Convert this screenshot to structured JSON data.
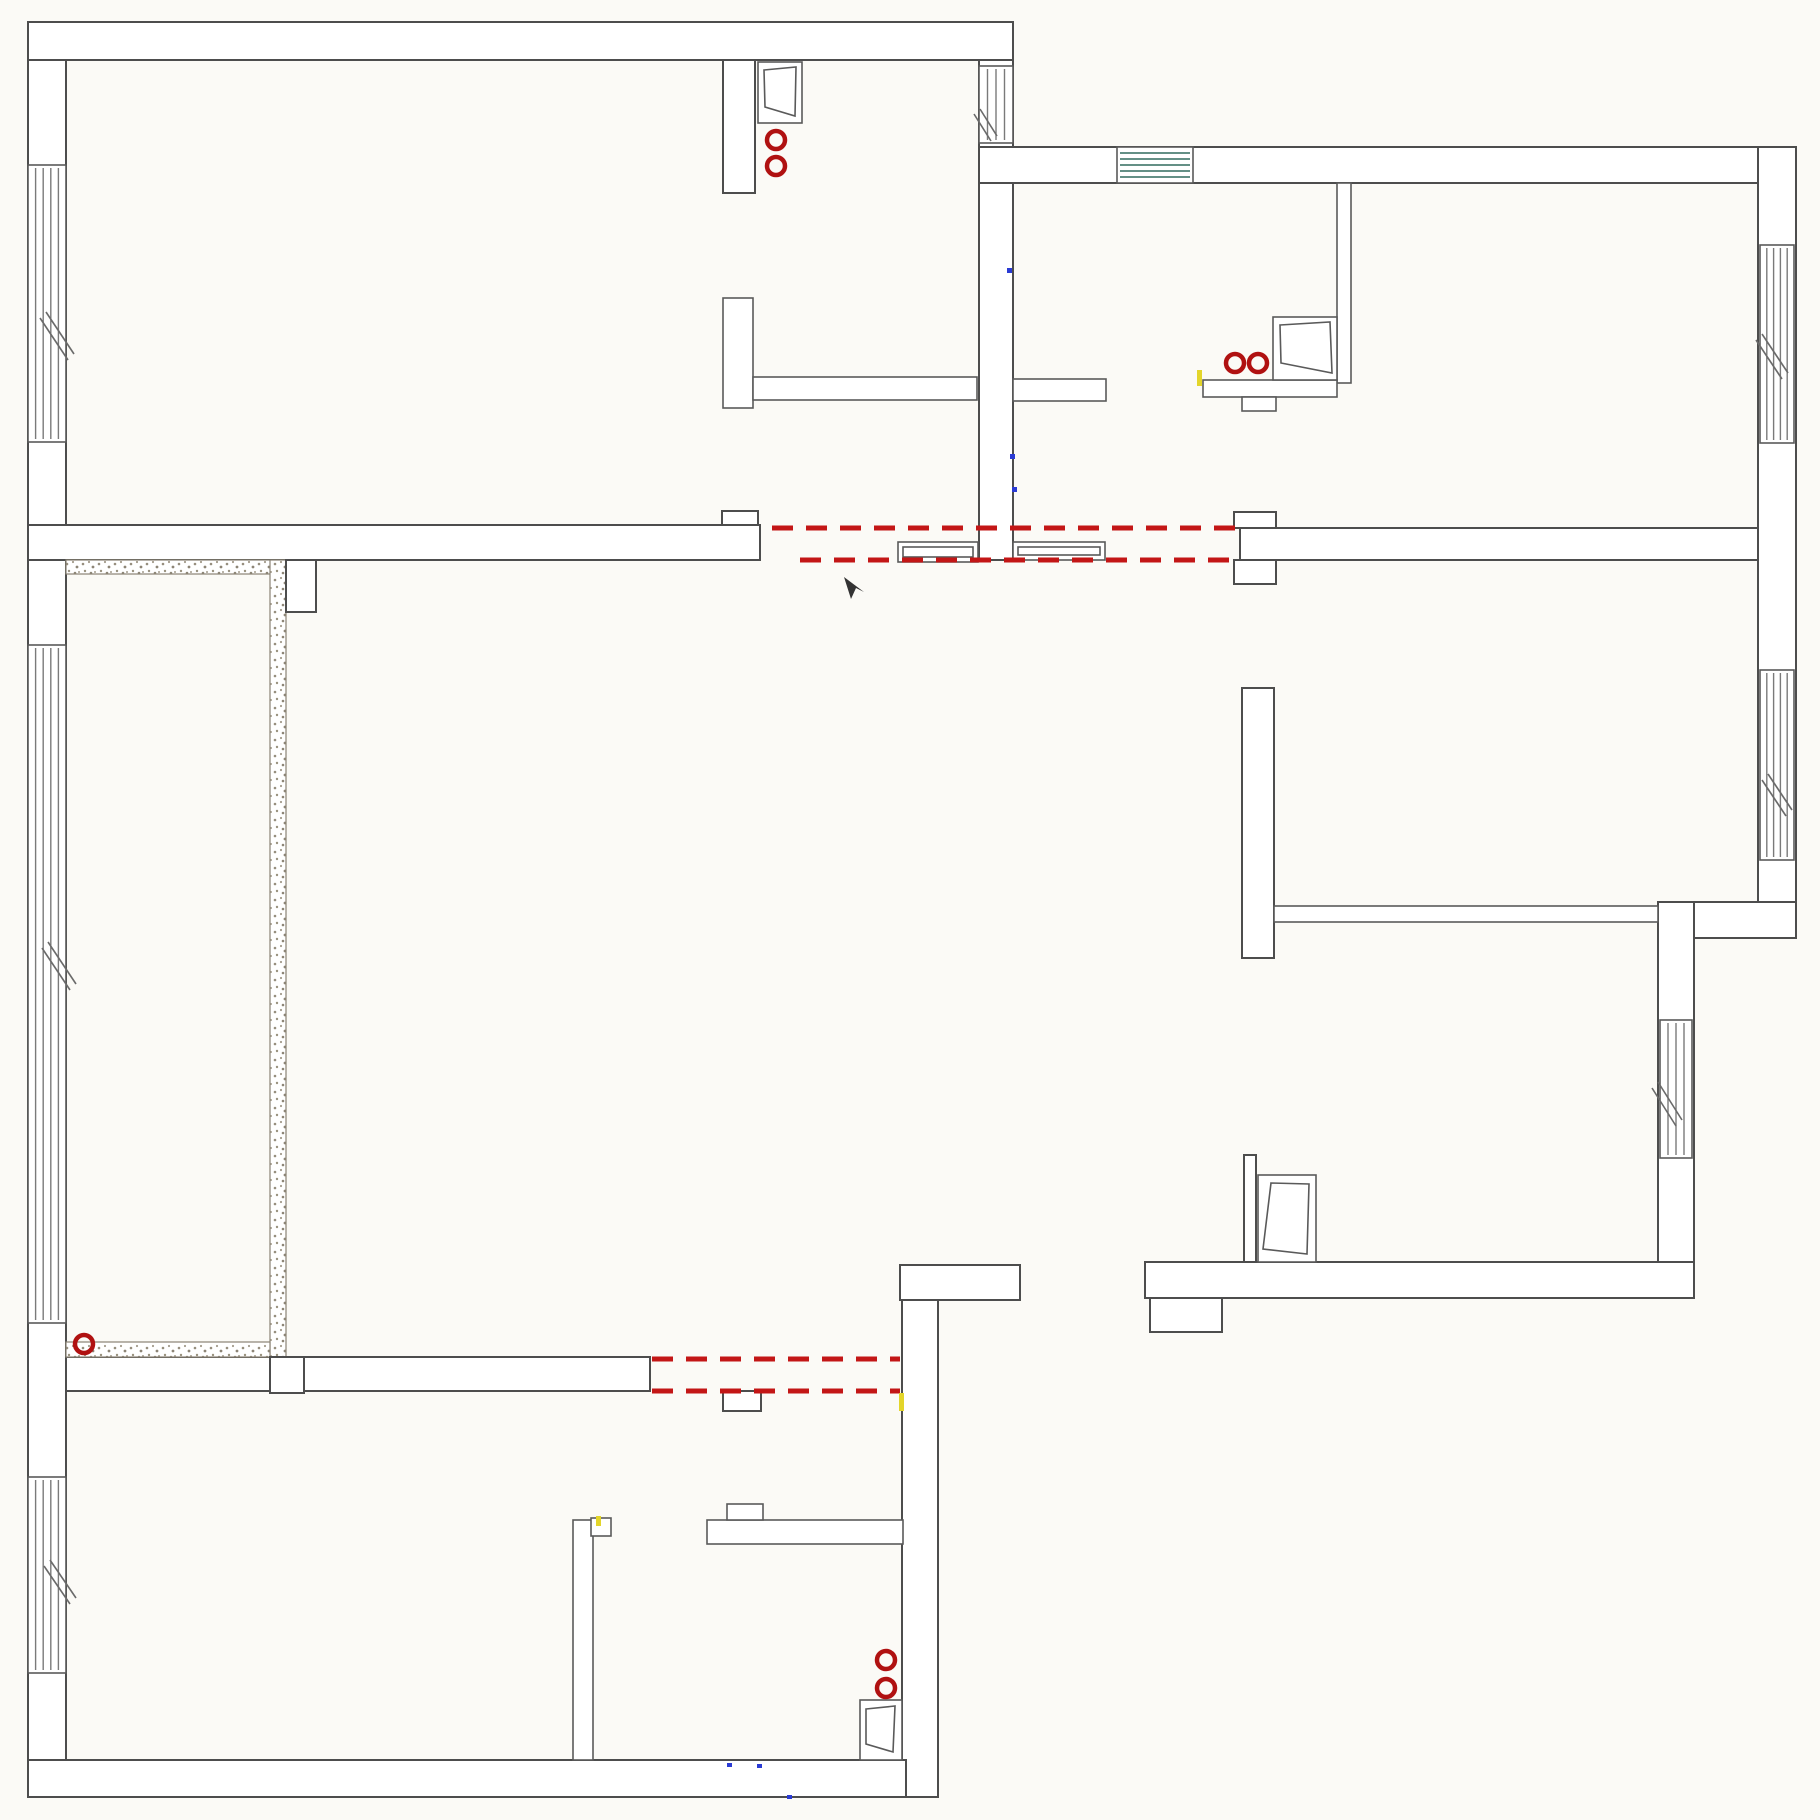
{
  "canvas": {
    "width": 1820,
    "height": 1820,
    "background": "#fbfaf6"
  },
  "palette": {
    "wall_line": "#4d4d4d",
    "thin_line": "#5a5a5a",
    "glass_line": "#7a7a7a",
    "glass_tint": "#316b5f",
    "demolition_red": "#c31616",
    "outlet_red": "#b01111",
    "speckle": "#8a8374",
    "mark_yellow": "#e3d52a",
    "mark_blue": "#2a3bd4",
    "arrow_dark": "#333333"
  },
  "plan": {
    "elements": [
      {
        "type": "rect",
        "name": "left-exterior-wall",
        "x": 28,
        "y": 22,
        "w": 38,
        "h": 1775
      },
      {
        "type": "rect",
        "name": "top-exterior-wall-west",
        "x": 28,
        "y": 22,
        "w": 985,
        "h": 38
      },
      {
        "type": "rect",
        "name": "entry-corridor-wall",
        "x": 979,
        "y": 60,
        "w": 34,
        "h": 500
      },
      {
        "type": "rect",
        "name": "top-exterior-wall-east",
        "x": 979,
        "y": 147,
        "w": 817,
        "h": 36
      },
      {
        "type": "rect",
        "name": "right-exterior-wall-upper",
        "x": 1758,
        "y": 147,
        "w": 38,
        "h": 791
      },
      {
        "type": "rect",
        "name": "right-exterior-step-wall",
        "x": 1658,
        "y": 902,
        "w": 138,
        "h": 36
      },
      {
        "type": "rect",
        "name": "right-exterior-wall-lower",
        "x": 1658,
        "y": 902,
        "w": 36,
        "h": 396
      },
      {
        "type": "rect",
        "name": "bottom-right-room-south-wall",
        "x": 1145,
        "y": 1262,
        "w": 549,
        "h": 36
      },
      {
        "type": "rect",
        "name": "bottom-right-room-pilaster",
        "x": 1150,
        "y": 1298,
        "w": 72,
        "h": 34
      },
      {
        "type": "rect",
        "name": "center-wall-bar",
        "x": 900,
        "y": 1265,
        "w": 120,
        "h": 35
      },
      {
        "type": "rect",
        "name": "center-wall-vertical",
        "x": 902,
        "y": 1300,
        "w": 36,
        "h": 497
      },
      {
        "type": "rect",
        "name": "bottom-exterior-wall",
        "x": 28,
        "y": 1760,
        "w": 878,
        "h": 37
      },
      {
        "type": "rect",
        "name": "top-left-room-south-wall",
        "x": 28,
        "y": 525,
        "w": 732,
        "h": 35
      },
      {
        "type": "rect",
        "name": "top-left-door-jamb",
        "x": 722,
        "y": 511,
        "w": 36,
        "h": 14
      },
      {
        "type": "rect",
        "name": "niche-divider-wall",
        "x": 723,
        "y": 60,
        "w": 32,
        "h": 133
      },
      {
        "type": "rect",
        "name": "bedroom-south-wall",
        "x": 1240,
        "y": 528,
        "w": 518,
        "h": 32
      },
      {
        "type": "rect",
        "name": "bedroom-door-jamb-upper",
        "x": 1234,
        "y": 512,
        "w": 42,
        "h": 16
      },
      {
        "type": "rect",
        "name": "bedroom-door-jamb-lower",
        "x": 1234,
        "y": 560,
        "w": 42,
        "h": 24
      },
      {
        "type": "rect",
        "name": "study-west-wall",
        "x": 1242,
        "y": 688,
        "w": 32,
        "h": 270
      },
      {
        "type": "rect",
        "name": "hall-south-wall",
        "x": 66,
        "y": 1357,
        "w": 584,
        "h": 34
      },
      {
        "type": "rect",
        "name": "hall-door-jamb",
        "x": 723,
        "y": 1391,
        "w": 38,
        "h": 20
      },
      {
        "type": "rect",
        "name": "bath-partition-wall",
        "x": 1244,
        "y": 1155,
        "w": 12,
        "h": 107
      },
      {
        "type": "rect",
        "cls": "thin",
        "name": "closet-wall-vertical",
        "x": 723,
        "y": 298,
        "w": 30,
        "h": 110
      },
      {
        "type": "rect",
        "cls": "thin",
        "name": "closet-rail-west",
        "x": 753,
        "y": 377,
        "w": 224,
        "h": 23
      },
      {
        "type": "rect",
        "cls": "thin",
        "name": "closet-rail-east",
        "x": 1013,
        "y": 379,
        "w": 93,
        "h": 22
      },
      {
        "type": "rect",
        "cls": "thin",
        "name": "study-south-wall",
        "x": 1274,
        "y": 906,
        "w": 384,
        "h": 16
      },
      {
        "type": "rect",
        "cls": "thin",
        "name": "kitchen-partition-wall",
        "x": 1337,
        "y": 183,
        "w": 14,
        "h": 200
      },
      {
        "type": "rect",
        "cls": "thin",
        "name": "kitchen-counter",
        "x": 1203,
        "y": 380,
        "w": 134,
        "h": 17
      },
      {
        "type": "rect",
        "cls": "thin",
        "name": "kitchen-counter-notch",
        "x": 1242,
        "y": 397,
        "w": 34,
        "h": 14
      },
      {
        "type": "rect",
        "cls": "thin",
        "name": "bath2-wall-vertical",
        "x": 573,
        "y": 1520,
        "w": 20,
        "h": 240
      },
      {
        "type": "rect",
        "cls": "thin",
        "name": "bath2-wall-vertical-notch",
        "x": 591,
        "y": 1518,
        "w": 20,
        "h": 18
      },
      {
        "type": "rect",
        "cls": "thin",
        "name": "bath2-wall-horizontal",
        "x": 707,
        "y": 1520,
        "w": 196,
        "h": 24
      },
      {
        "type": "rect",
        "cls": "thin",
        "name": "bath2-wall-horizontal-notch",
        "x": 727,
        "y": 1504,
        "w": 36,
        "h": 16
      },
      {
        "type": "speck",
        "name": "balcony-wall-north",
        "x": 66,
        "y": 560,
        "w": 220,
        "h": 14
      },
      {
        "type": "speck",
        "name": "balcony-wall-east",
        "x": 270,
        "y": 560,
        "w": 16,
        "h": 797
      },
      {
        "type": "speck",
        "name": "balcony-wall-south",
        "x": 66,
        "y": 1342,
        "w": 204,
        "h": 15
      },
      {
        "type": "rect",
        "name": "balcony-column",
        "x": 286,
        "y": 560,
        "w": 30,
        "h": 52
      },
      {
        "type": "rect",
        "name": "balcony-door-jamb",
        "x": 270,
        "y": 1357,
        "w": 34,
        "h": 36
      },
      {
        "type": "window",
        "name": "window-west-1",
        "x": 28,
        "y": 165,
        "w": 38,
        "h": 277,
        "orient": "v",
        "lines": 4
      },
      {
        "type": "window",
        "name": "window-west-balcony",
        "x": 28,
        "y": 645,
        "w": 38,
        "h": 678,
        "orient": "v",
        "lines": 4
      },
      {
        "type": "window",
        "name": "window-west-2",
        "x": 28,
        "y": 1477,
        "w": 38,
        "h": 196,
        "orient": "v",
        "lines": 4
      },
      {
        "type": "window",
        "name": "window-entry",
        "x": 979,
        "y": 66,
        "w": 34,
        "h": 77,
        "orient": "v",
        "lines": 3
      },
      {
        "type": "window",
        "name": "window-north",
        "x": 1117,
        "y": 147,
        "w": 76,
        "h": 36,
        "orient": "h",
        "lines": 5,
        "tint": "glass_tint"
      },
      {
        "type": "window",
        "name": "window-east-1",
        "x": 1760,
        "y": 245,
        "w": 34,
        "h": 198,
        "orient": "v",
        "lines": 4
      },
      {
        "type": "window",
        "name": "window-east-2",
        "x": 1760,
        "y": 670,
        "w": 34,
        "h": 190,
        "orient": "v",
        "lines": 4
      },
      {
        "type": "window",
        "name": "window-east-3",
        "x": 1660,
        "y": 1020,
        "w": 32,
        "h": 138,
        "orient": "v",
        "lines": 3
      },
      {
        "type": "panel",
        "name": "pocket-door-panel-west",
        "x": 898,
        "y": 542,
        "w": 80,
        "h": 20
      },
      {
        "type": "panel",
        "name": "pocket-door-panel-east",
        "x": 1013,
        "y": 542,
        "w": 92,
        "h": 18
      },
      {
        "type": "casement",
        "name": "casement-window-niche",
        "frame": [
          758,
          62,
          44,
          61
        ],
        "sash": [
          [
            764,
            70
          ],
          [
            796,
            67
          ],
          [
            795,
            116
          ],
          [
            765,
            107
          ]
        ]
      },
      {
        "type": "casement",
        "name": "casement-window-kitchen",
        "frame": [
          1273,
          317,
          64,
          63
        ],
        "sash": [
          [
            1280,
            325
          ],
          [
            1330,
            322
          ],
          [
            1332,
            373
          ],
          [
            1281,
            363
          ]
        ]
      },
      {
        "type": "casement",
        "name": "casement-window-bottom-left",
        "frame": [
          860,
          1700,
          42,
          60
        ],
        "sash": [
          [
            866,
            1709
          ],
          [
            895,
            1706
          ],
          [
            893,
            1752
          ],
          [
            866,
            1744
          ]
        ]
      },
      {
        "type": "casement",
        "name": "casement-window-bath",
        "frame": [
          1258,
          1175,
          58,
          87
        ],
        "sash": [
          [
            1271,
            1183
          ],
          [
            1309,
            1184
          ],
          [
            1307,
            1254
          ],
          [
            1263,
            1249
          ]
        ]
      },
      {
        "type": "dash",
        "name": "demolition-line-1",
        "x1": 772,
        "y1": 528,
        "x2": 1238,
        "y2": 528
      },
      {
        "type": "dash",
        "name": "demolition-line-2",
        "x1": 800,
        "y1": 560,
        "x2": 1238,
        "y2": 560
      },
      {
        "type": "dash",
        "name": "demolition-line-3",
        "x1": 652,
        "y1": 1359,
        "x2": 900,
        "y2": 1359
      },
      {
        "type": "dash",
        "name": "demolition-line-4",
        "x1": 652,
        "y1": 1391,
        "x2": 900,
        "y2": 1391
      },
      {
        "type": "circle",
        "name": "outlet-niche-1",
        "cx": 776,
        "cy": 140,
        "r": 9
      },
      {
        "type": "circle",
        "name": "outlet-niche-2",
        "cx": 776,
        "cy": 166,
        "r": 9
      },
      {
        "type": "circle",
        "name": "outlet-kitchen-1",
        "cx": 1235,
        "cy": 363,
        "r": 9
      },
      {
        "type": "circle",
        "name": "outlet-kitchen-2",
        "cx": 1258,
        "cy": 363,
        "r": 9
      },
      {
        "type": "circle",
        "name": "outlet-balcony",
        "cx": 84,
        "cy": 1344,
        "r": 9
      },
      {
        "type": "circle",
        "name": "outlet-bottom-left-1",
        "cx": 886,
        "cy": 1660,
        "r": 9
      },
      {
        "type": "circle",
        "name": "outlet-bottom-left-2",
        "cx": 886,
        "cy": 1688,
        "r": 9
      },
      {
        "type": "tick",
        "name": "swing-mark-west-1",
        "lines": [
          [
            40,
            318,
            68,
            360
          ],
          [
            46,
            312,
            74,
            354
          ]
        ]
      },
      {
        "type": "tick",
        "name": "swing-mark-west-2",
        "lines": [
          [
            42,
            948,
            70,
            990
          ],
          [
            48,
            942,
            76,
            984
          ]
        ]
      },
      {
        "type": "tick",
        "name": "swing-mark-west-3",
        "lines": [
          [
            44,
            1566,
            70,
            1604
          ],
          [
            50,
            1560,
            76,
            1598
          ]
        ]
      },
      {
        "type": "tick",
        "name": "swing-mark-entry",
        "lines": [
          [
            974,
            114,
            991,
            141
          ],
          [
            980,
            109,
            997,
            136
          ]
        ]
      },
      {
        "type": "tick",
        "name": "swing-mark-east-1",
        "lines": [
          [
            1756,
            340,
            1782,
            379
          ],
          [
            1762,
            334,
            1788,
            373
          ]
        ]
      },
      {
        "type": "tick",
        "name": "swing-mark-east-2",
        "lines": [
          [
            1762,
            780,
            1786,
            816
          ],
          [
            1768,
            774,
            1792,
            810
          ]
        ]
      },
      {
        "type": "tick",
        "name": "swing-mark-east-3",
        "lines": [
          [
            1652,
            1088,
            1676,
            1126
          ],
          [
            1658,
            1082,
            1682,
            1120
          ]
        ]
      },
      {
        "type": "mark",
        "name": "mark-yellow-kitchen",
        "x": 1197,
        "y": 370,
        "w": 5,
        "h": 16,
        "color_key": "mark_yellow"
      },
      {
        "type": "mark",
        "name": "mark-yellow-center-wall",
        "x": 899,
        "y": 1393,
        "w": 5,
        "h": 18,
        "color_key": "mark_yellow"
      },
      {
        "type": "mark",
        "name": "mark-yellow-bath2",
        "x": 596,
        "y": 1516,
        "w": 5,
        "h": 10,
        "color_key": "mark_yellow"
      },
      {
        "type": "mark",
        "name": "mark-blue-corridor-1",
        "x": 1007,
        "y": 268,
        "w": 5,
        "h": 5,
        "color_key": "mark_blue"
      },
      {
        "type": "mark",
        "name": "mark-blue-corridor-2",
        "x": 1010,
        "y": 454,
        "w": 5,
        "h": 5,
        "color_key": "mark_blue"
      },
      {
        "type": "mark",
        "name": "mark-blue-corridor-3",
        "x": 1012,
        "y": 487,
        "w": 5,
        "h": 5,
        "color_key": "mark_blue"
      },
      {
        "type": "mark",
        "name": "mark-blue-bottom-1",
        "x": 727,
        "y": 1763,
        "w": 5,
        "h": 4,
        "color_key": "mark_blue"
      },
      {
        "type": "mark",
        "name": "mark-blue-bottom-2",
        "x": 757,
        "y": 1764,
        "w": 5,
        "h": 4,
        "color_key": "mark_blue"
      },
      {
        "type": "mark",
        "name": "mark-blue-bottom-3",
        "x": 787,
        "y": 1795,
        "w": 5,
        "h": 4,
        "color_key": "mark_blue"
      },
      {
        "type": "poly",
        "name": "pointer-arrow",
        "points": [
          [
            844,
            577
          ],
          [
            851,
            599
          ],
          [
            856,
            588
          ],
          [
            864,
            592
          ]
        ],
        "color_key": "arrow_dark"
      }
    ]
  }
}
